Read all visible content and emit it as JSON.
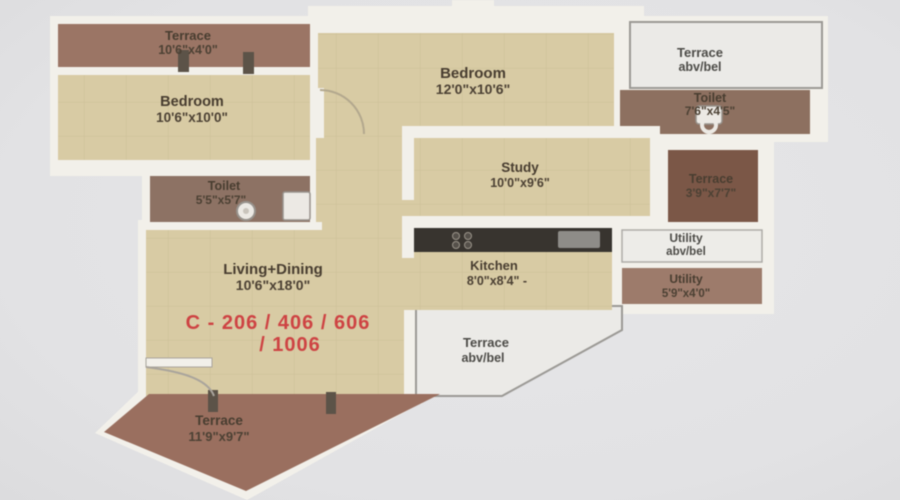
{
  "rooms": {
    "terrace_tl": {
      "name": "Terrace",
      "dims": "10'6\"x4'0\""
    },
    "bedroom_left": {
      "name": "Bedroom",
      "dims": "10'6\"x10'0\""
    },
    "bedroom_top": {
      "name": "Bedroom",
      "dims": "12'0\"x10'6\""
    },
    "terrace_abv_top": {
      "name": "Terrace",
      "dims": "abv/bel"
    },
    "toilet_right": {
      "name": "Toilet",
      "dims": "7'6\"x4'5\""
    },
    "study": {
      "name": "Study",
      "dims": "10'0\"x9'6\""
    },
    "terrace_right": {
      "name": "Terrace",
      "dims": "3'9\"x7'7\""
    },
    "toilet_left": {
      "name": "Toilet",
      "dims": "5'5\"x5'7\""
    },
    "utility_abv": {
      "name": "Utility",
      "dims": "abv/bel"
    },
    "kitchen": {
      "name": "Kitchen",
      "dims": "8'0\"x8'4\" -"
    },
    "utility_right": {
      "name": "Utility",
      "dims": "5'9\"x4'0\""
    },
    "living_dining": {
      "name": "Living+Dining",
      "dims": "10'6\"x18'0\""
    },
    "terrace_abv_bottom": {
      "name": "Terrace",
      "dims": "abv/bel"
    },
    "terrace_bottom": {
      "name": "Terrace",
      "dims": "11'9\"x9'7\""
    }
  },
  "unit_label": {
    "line1": "C - 206 / 406 / 606",
    "line2": "/ 1006"
  },
  "colors": {
    "background": "#e3e3e5",
    "wall": "#f2f0ea",
    "floor_beige": "#d8cba4",
    "tile_line": "#c9ba92",
    "terrace_brown": "#9b7060",
    "toilet_brown": "#8d7264",
    "terrace_right_brown": "#7b5747",
    "utility_brown": "#9d7b6b",
    "open_area_fill": "#ebeae7",
    "open_area_border": "#9b9995",
    "counter_dark": "#38342f",
    "label_text": "#4a3f33",
    "unit_red": "#ce4343"
  }
}
